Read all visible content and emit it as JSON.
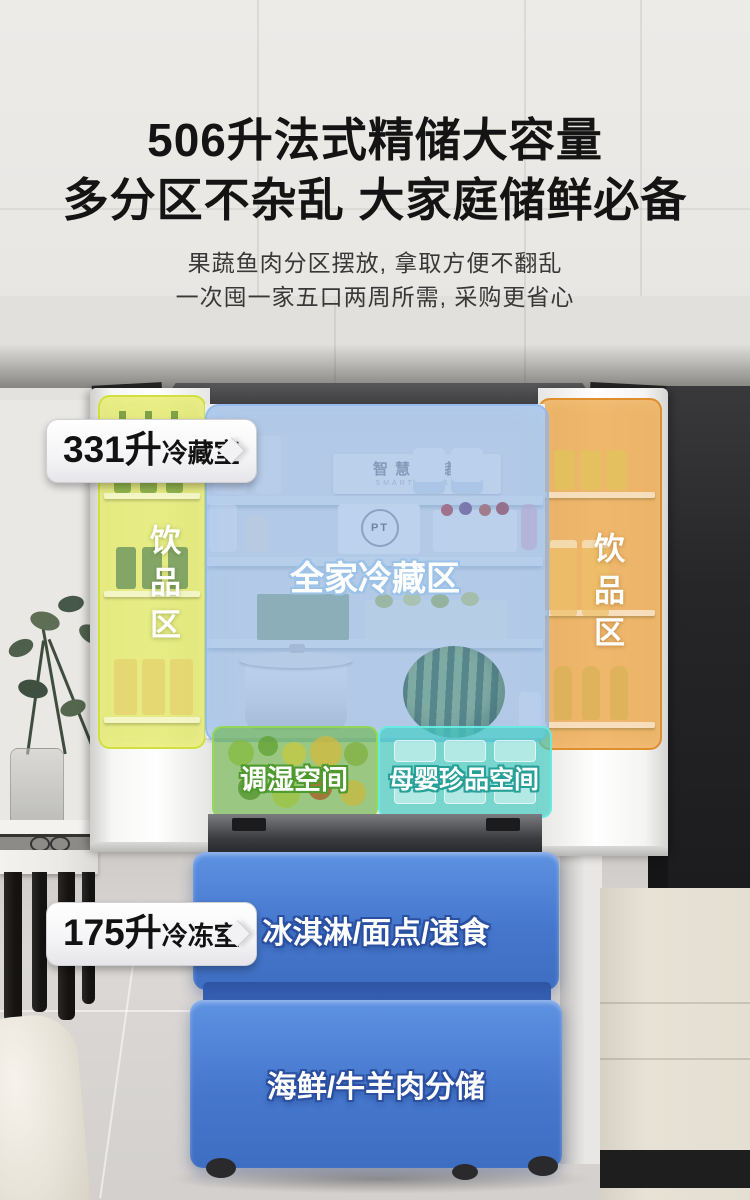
{
  "header": {
    "title_line1": "506升法式精储大容量",
    "title_line2": "多分区不杂乱 大家庭储鲜必备",
    "desc_line1": "果蔬鱼肉分区摆放, 拿取方便不翻乱",
    "desc_line2": "一次囤一家五口两周所需, 采购更省心"
  },
  "callouts": {
    "fridge_volume": "331升",
    "fridge_label": "冷藏室",
    "freezer_volume": "175升",
    "freezer_label": "冷冻室"
  },
  "zones": {
    "left_door_label": "饮品区",
    "right_door_label": "饮品区",
    "center_label": "全家冷藏区",
    "humidity_drawer_label": "调湿空间",
    "mother_baby_drawer_label": "母婴珍品空间",
    "freezer_top_label": "冰淇淋/面点/速食",
    "freezer_bottom_label": "海鲜/牛羊肉分储"
  },
  "interior": {
    "smart_sign_text": "智慧鲜储",
    "smart_sign_subtext": "SMART FRESH",
    "pt_logo_text": "PT"
  },
  "colors": {
    "beverage_left_overlay": "#dde24f",
    "beverage_right_overlay": "#eaa246",
    "fridge_center_overlay": "#7ca6dc",
    "humidity_drawer_overlay": "#69b446",
    "mother_baby_overlay": "#3ecdc4",
    "freezer_overlay": "#4a7fd6",
    "badge_background": "#ffffff",
    "title_color": "#141414"
  }
}
